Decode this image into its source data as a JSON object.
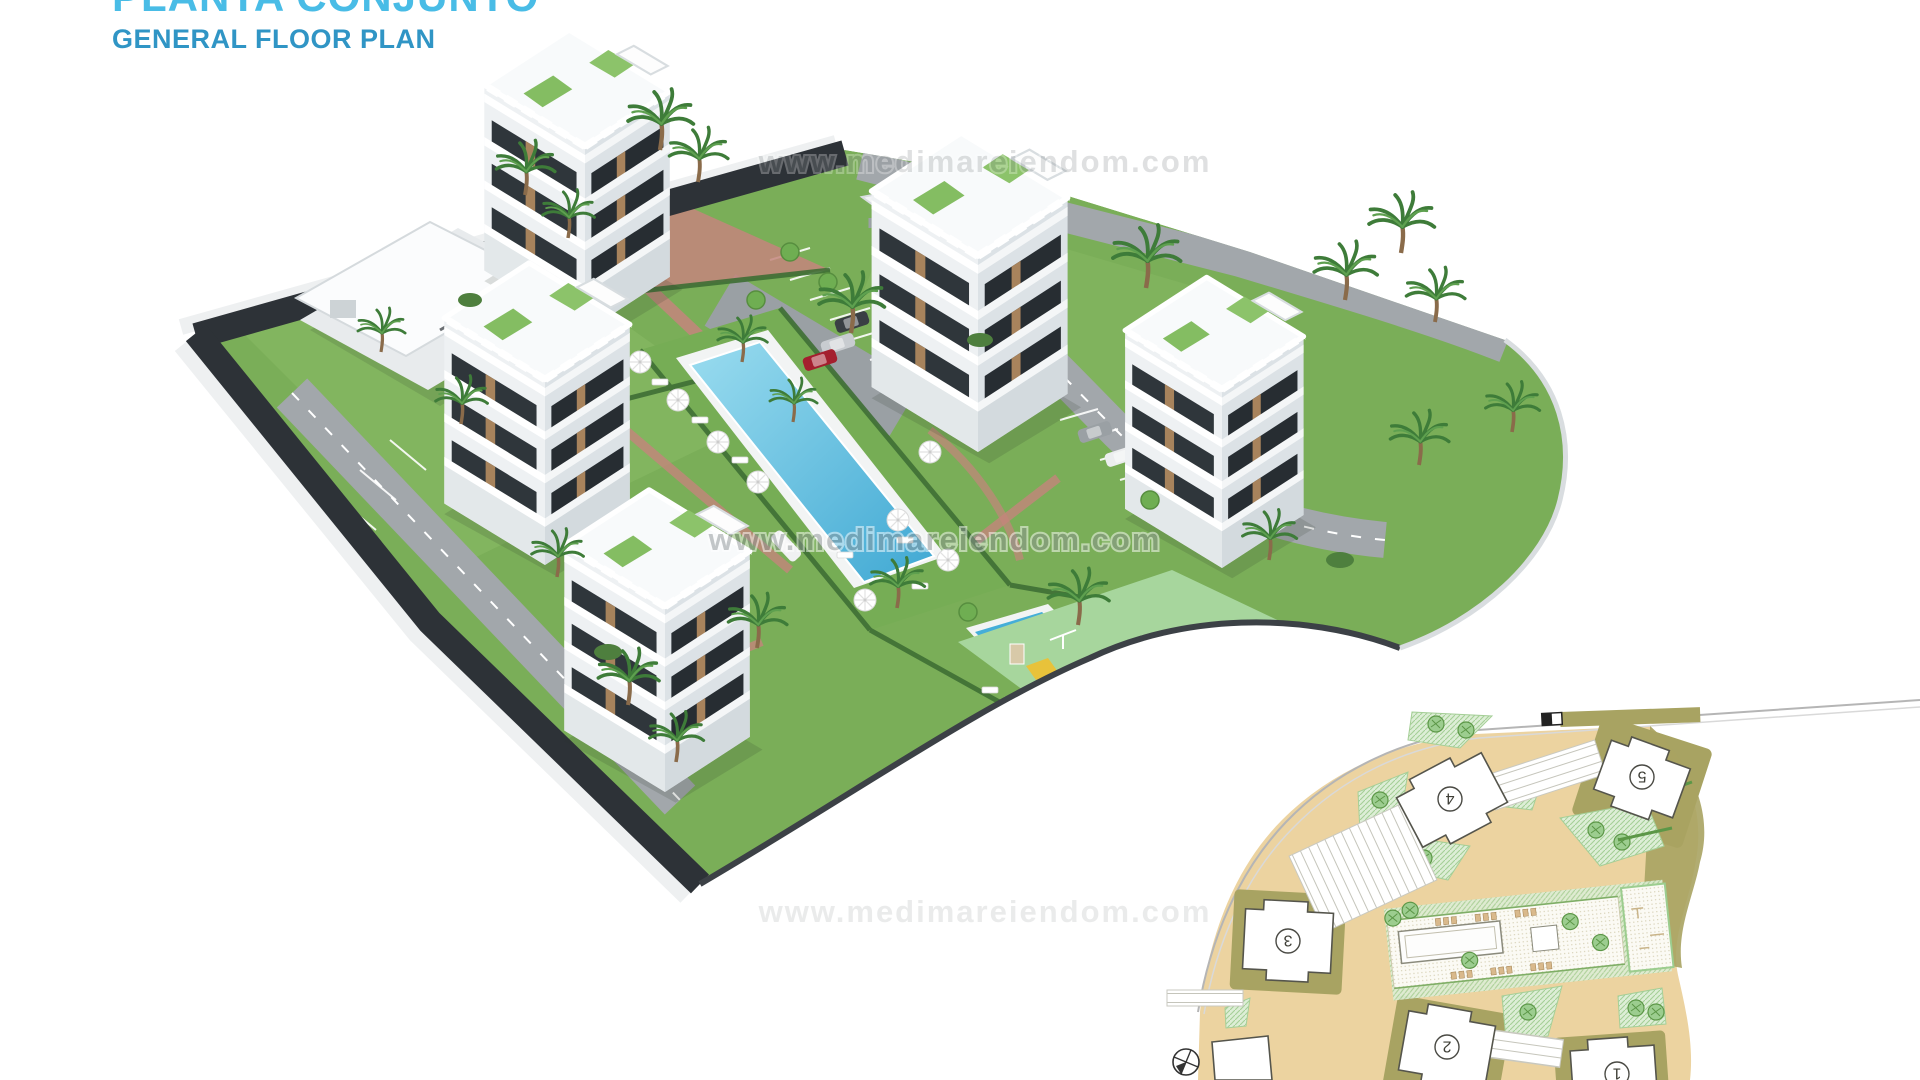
{
  "header": {
    "title_line1": "PLANTA CONJUNTO",
    "title_line2": "GENERAL FLOOR PLAN",
    "title_color_primary": "#49bce6",
    "title_color_secondary": "#3095c5",
    "note": "title_line1 is clipped at the top edge of the image"
  },
  "watermark": {
    "text": "www.medimareiendom.com",
    "color": "#8e9496"
  },
  "render3d": {
    "type": "aerial-3d-render",
    "colors": {
      "lawn": "#7aae58",
      "lawn_light": "#8aba66",
      "pool_blue": "#45aed8",
      "pool_light": "#9adcef",
      "playground_green": "#a7d69d",
      "perimeter_road": "#2d3237",
      "asphalt": "#a2a7ab",
      "brick_path": "#c4857c",
      "hedge": "#3f6f35",
      "building_white": "#eef1f3",
      "building_shade": "#dce2e6",
      "wood_accent": "#b48c60"
    }
  },
  "site_plan_inset": {
    "orientation": "rotated-180",
    "colors": {
      "road_tan": "#ecd3a0",
      "block_khaki": "#a8a362",
      "landscape_hatch": "#ddeed6",
      "building_fill": "#ffffff",
      "outline": "#55554c"
    },
    "compass_icon": "compass-north",
    "buildings": [
      {
        "label": "1"
      },
      {
        "label": "2"
      },
      {
        "label": "3"
      },
      {
        "label": "4"
      },
      {
        "label": "5"
      }
    ]
  }
}
